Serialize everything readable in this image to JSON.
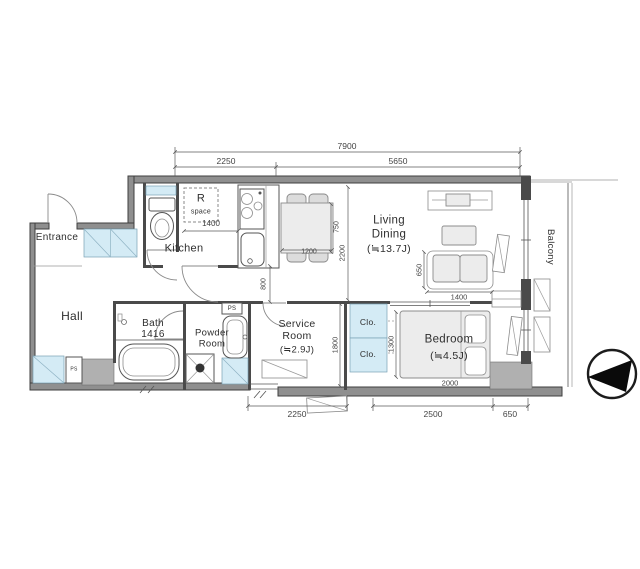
{
  "rooms": {
    "entrance": "Entrance",
    "hall": "Hall",
    "kitchen": "Kitchen",
    "bath_name": "Bath",
    "bath_size": "1416",
    "powder_1": "Powder",
    "powder_2": "Room",
    "service_1": "Service",
    "service_2": "Room",
    "service_3": "(≒2.9J)",
    "living_1": "Living",
    "living_2": "Dining",
    "living_3": "(≒13.7J)",
    "bedroom_1": "Bedroom",
    "bedroom_2": "(≒4.5J)",
    "closet_top": "Clo.",
    "closet_bottom": "Clo.",
    "balcony": "Balcony",
    "r_space_1": "R",
    "r_space_2": "space",
    "ps_hall": "PS",
    "ps_powder": "PS"
  },
  "dimensions": {
    "top_total": "7900",
    "top_left": "2250",
    "top_right": "5650",
    "kitchen_front": "1400",
    "table_w": "1200",
    "table_d": "750",
    "corridor": "800",
    "ld_width": "2200",
    "sofa_d": "650",
    "sofa_w": "1400",
    "service_d": "1800",
    "bed_d": "1300",
    "bed_w": "2000",
    "bottom_left": "2250",
    "bottom_mid": "2500",
    "bottom_right": "650"
  },
  "colors": {
    "wall_fill": "#8f8f8f",
    "fixture_blue": "#d4ebf5",
    "line_dark": "#4a4a4a",
    "compass_black": "#0a0a0a"
  }
}
